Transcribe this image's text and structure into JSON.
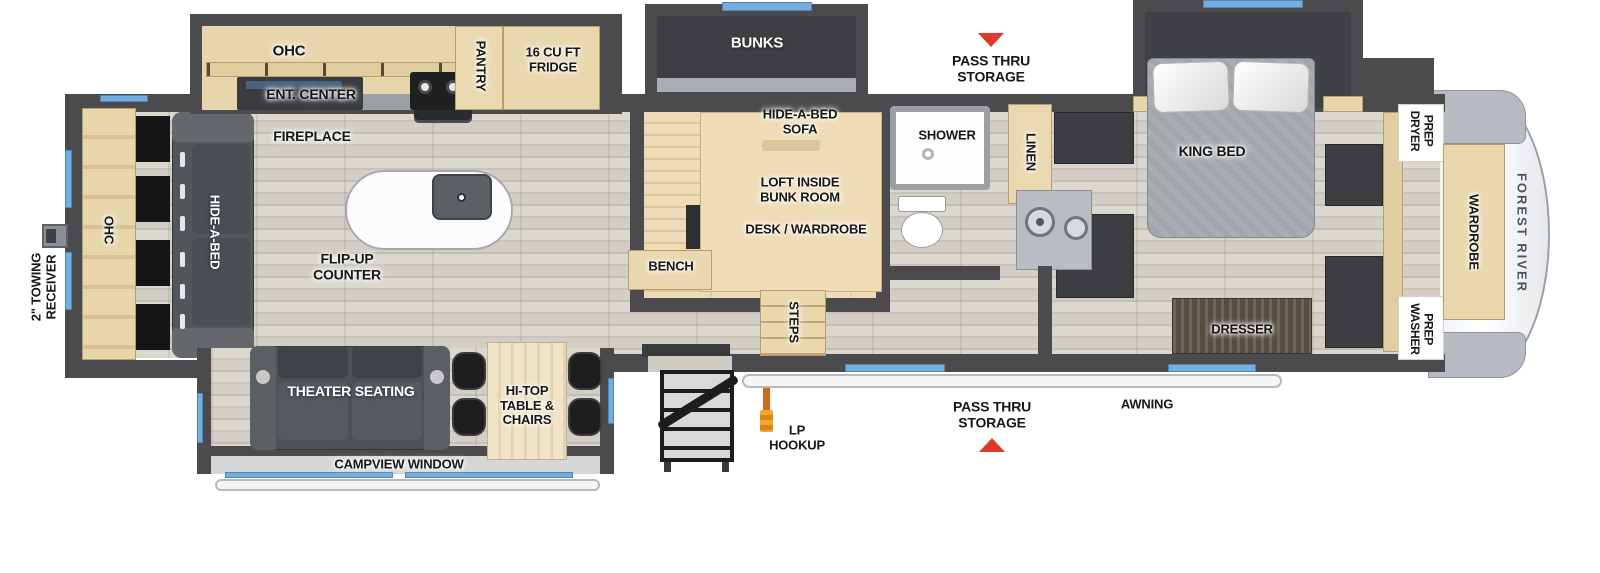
{
  "plan_title": "Forest River fifth wheel floorplan",
  "colors": {
    "wall": "#4b4b4d",
    "wood": "#e7d5ac",
    "accent_blue": "#74aede",
    "arrow_red": "#e2382c",
    "lp_orange": "#d9821c",
    "brand_gray": "#4c5157"
  },
  "exterior": {
    "towing_receiver": "2\" TOWING\nRECEIVER",
    "pass_thru_top": "PASS THRU\nSTORAGE",
    "pass_thru_bottom": "PASS THRU\nSTORAGE",
    "lp_hookup": "LP\nHOOKUP",
    "awning": "AWNING",
    "campview_window": "CAMPVIEW WINDOW",
    "brand": "FOREST RIVER"
  },
  "kitchen": {
    "ohc": "OHC",
    "ent_center": "ENT. CENTER",
    "pantry": "PANTRY",
    "fridge": "16 CU FT\nFRIDGE",
    "fireplace": "FIREPLACE",
    "flip_up_counter": "FLIP-UP\nCOUNTER"
  },
  "rear_living": {
    "ohc": "OHC",
    "hide_a_bed": "HIDE-A-BED",
    "theater_seating": "THEATER SEATING",
    "hi_top": "HI-TOP\nTABLE &\nCHAIRS"
  },
  "bunk_room": {
    "bunks": "BUNKS",
    "hide_a_bed_sofa": "HIDE-A-BED\nSOFA",
    "loft": "LOFT INSIDE\nBUNK ROOM",
    "desk_wardrobe": "DESK / WARDROBE",
    "bench": "BENCH",
    "steps": "STEPS"
  },
  "bathroom": {
    "shower": "SHOWER",
    "linen": "LINEN"
  },
  "bedroom": {
    "king_bed": "KING BED",
    "dresser": "DRESSER",
    "dryer_prep": "DRYER\nPREP",
    "washer_prep": "WASHER\nPREP",
    "wardrobe": "WARDROBE"
  }
}
